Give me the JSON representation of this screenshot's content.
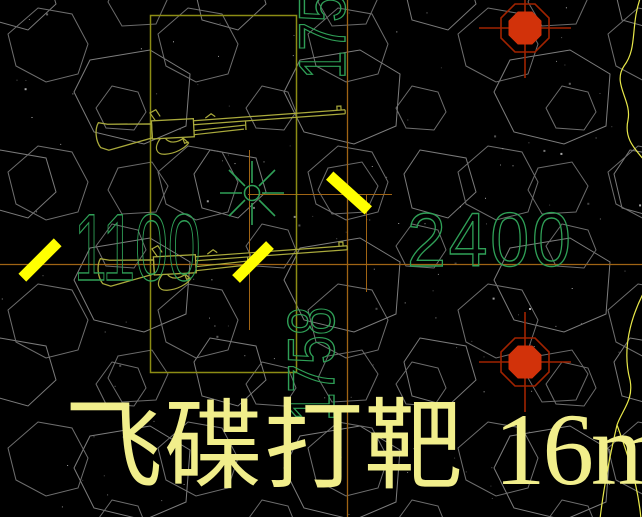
{
  "viewport": {
    "type": "cad-drawing-canvas",
    "background": "#000000"
  },
  "labels": {
    "dim_horizontal_left": "1100",
    "dim_horizontal_right": "2400",
    "dim_vertical_top": "1758",
    "dim_vertical_bottom": "1758",
    "title_cn": "飞碟打靶",
    "title_area": "16m²"
  },
  "icons": {
    "clay-target-marker": "red filled octagon with crosshair",
    "sun-symbol": "green 8-ray star with center circle",
    "rifle": "olive lever-action rifle outline",
    "clay-flight-dash": "thick yellow diagonal bar",
    "terrain-hatch": "gray irregular polygon rubble pattern"
  },
  "colors": {
    "dim_text_green": "#2fa057",
    "entity_olive": "#aaaa3c",
    "boundary_olive": "#8c8c14",
    "dimension_rust": "#a06414",
    "dash_yellow": "#ffff00",
    "marker_red_fill": "#d2320a",
    "marker_red_line": "#a02300",
    "title_khaki": "#f1ee8b",
    "hatch_gray": "#747474"
  }
}
